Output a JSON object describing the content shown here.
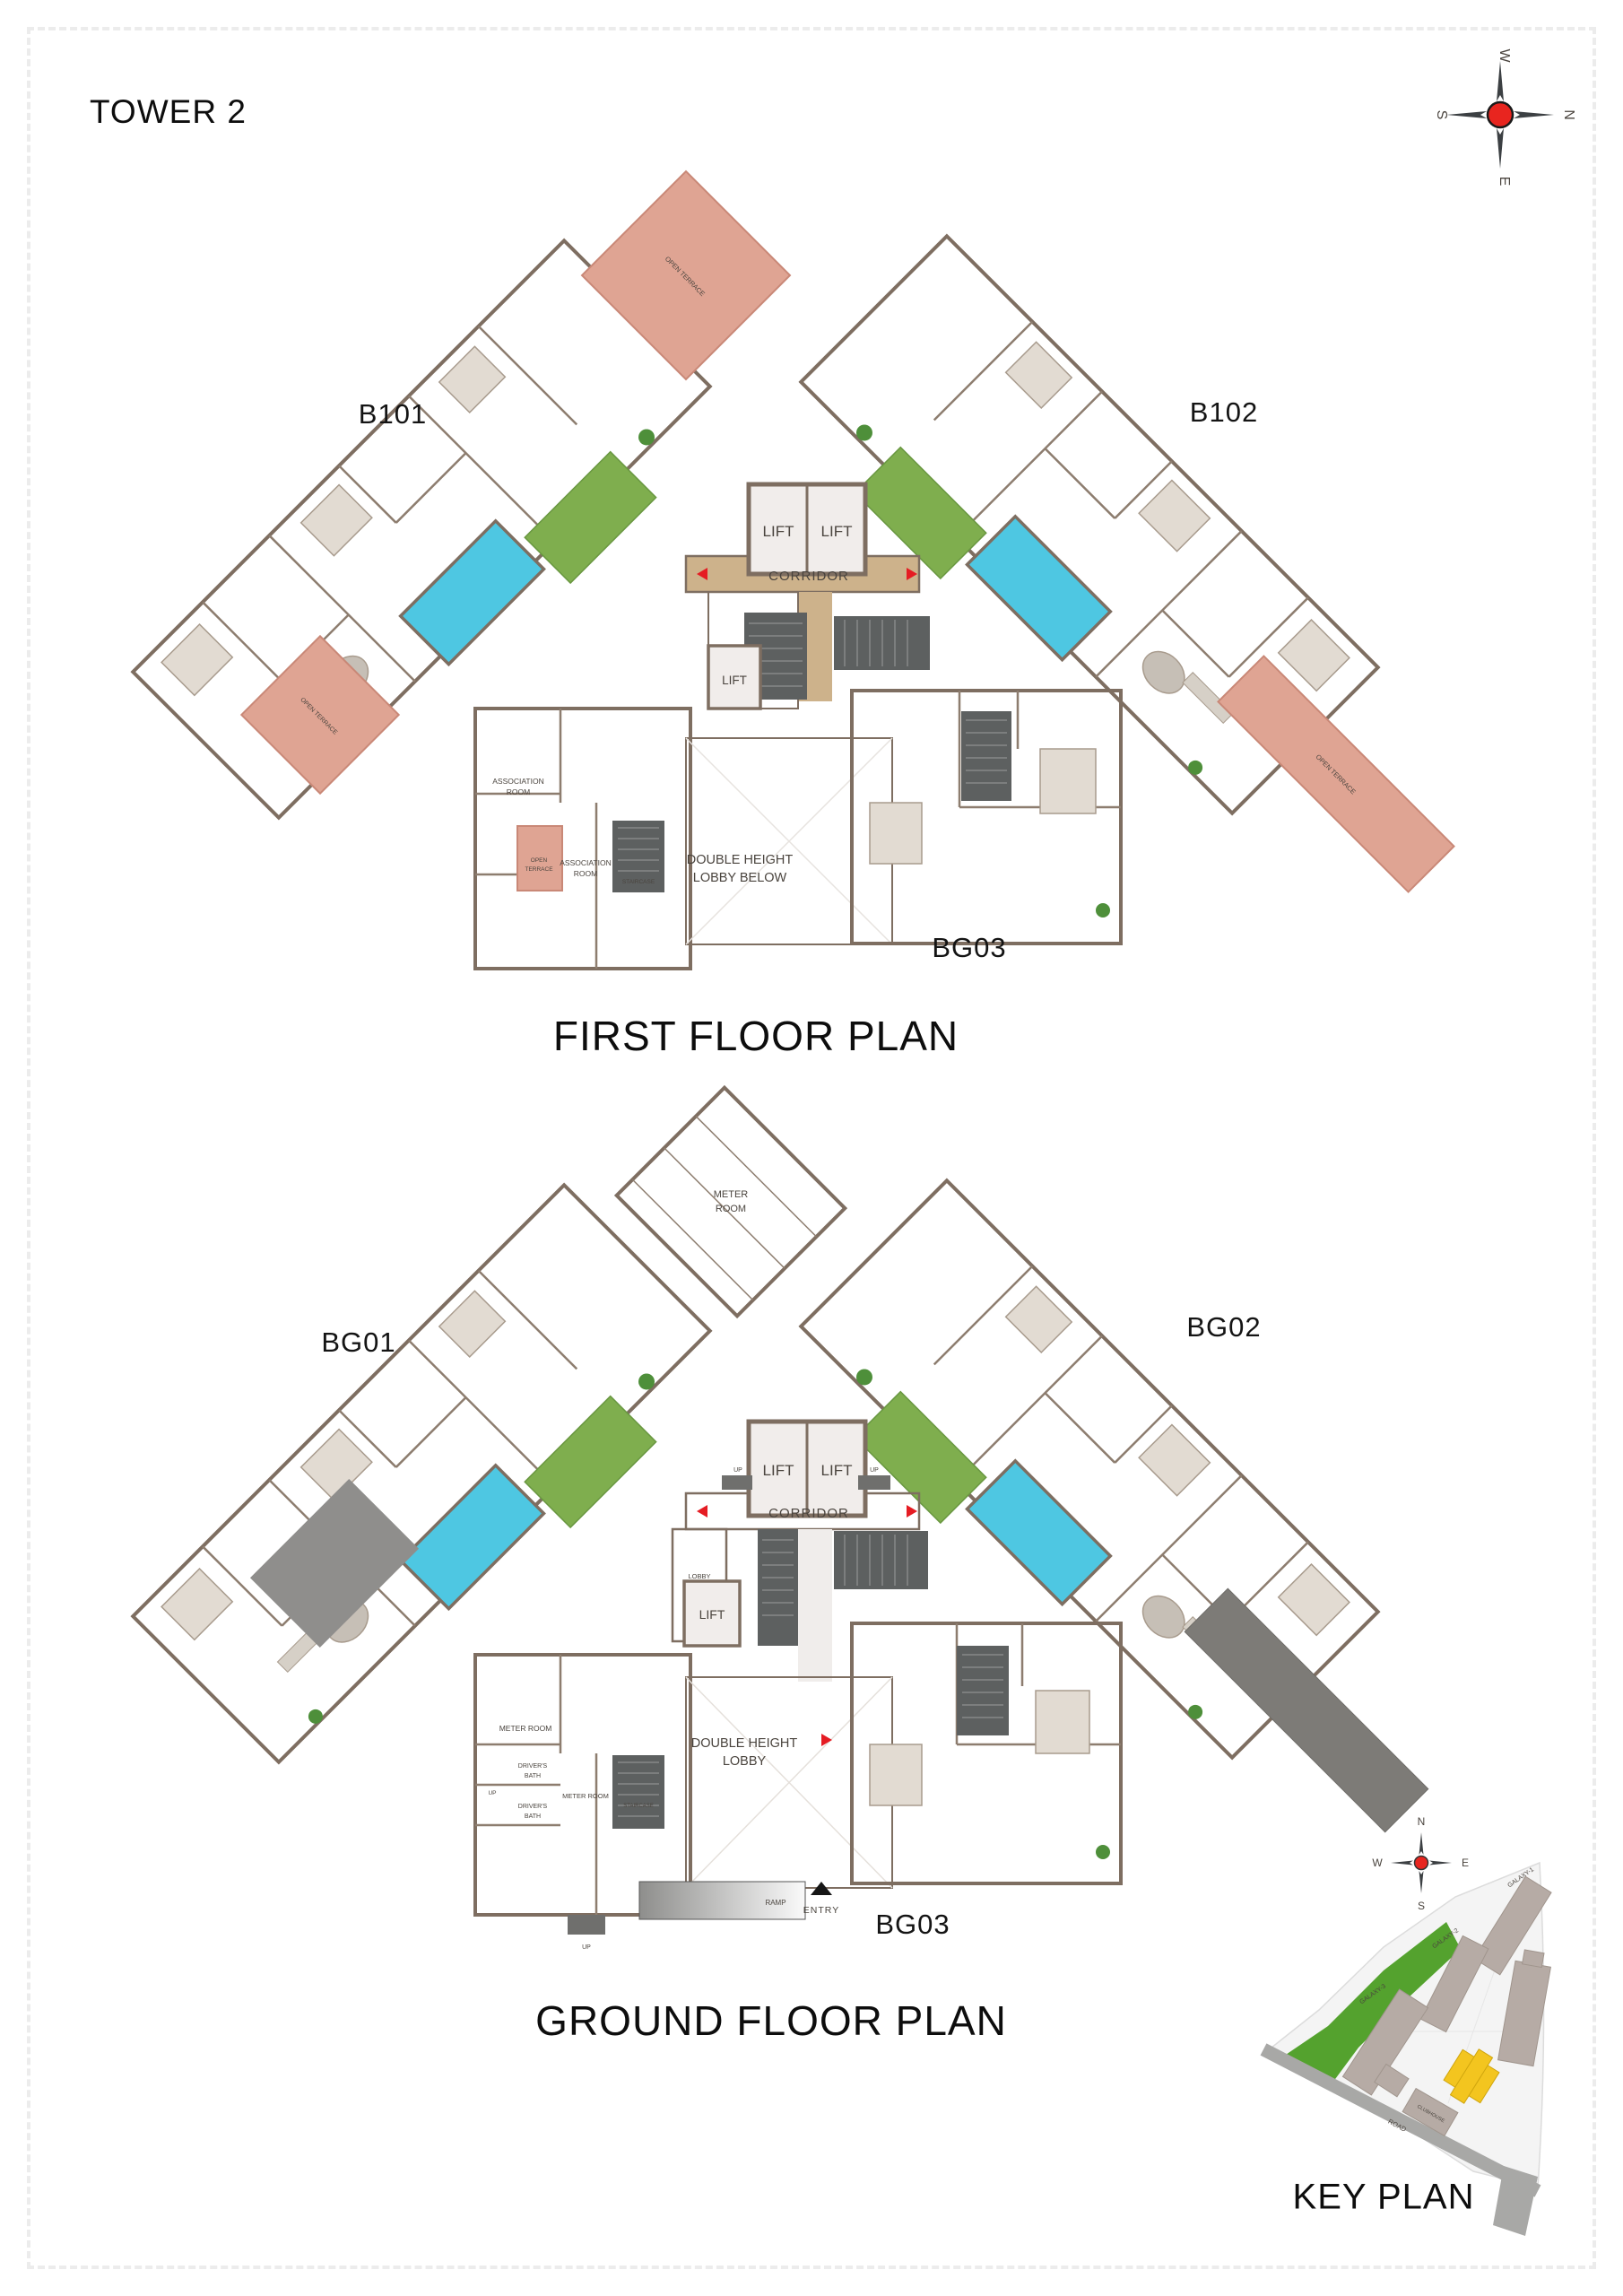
{
  "tower_title": "TOWER 2",
  "compass": {
    "n": "N",
    "e": "E",
    "s": "S",
    "w": "W"
  },
  "first_floor": {
    "title": "FIRST FLOOR PLAN",
    "units": {
      "left": "B101",
      "right": "B102",
      "bottom": "BG03"
    },
    "labels": {
      "lift": "LIFT",
      "corridor": "CORRIDOR",
      "staircase": "STAIRCASE",
      "association_room": [
        "ASSOCIATION",
        "ROOM"
      ],
      "open_terrace": "OPEN TERRACE",
      "open_terrace_lines": [
        "OPEN",
        "TERRACE"
      ],
      "double_height_lobby_below": [
        "DOUBLE HEIGHT",
        "LOBBY BELOW"
      ]
    }
  },
  "ground_floor": {
    "title": "GROUND FLOOR PLAN",
    "units": {
      "left": "BG01",
      "right": "BG02",
      "bottom": "BG03"
    },
    "labels": {
      "lift": "LIFT",
      "corridor": "CORRIDOR",
      "lobby": "LOBBY",
      "up": "UP",
      "staircase": "STAIRCASE",
      "meter_room": [
        "METER",
        "ROOM"
      ],
      "meter_room_inline": "METER ROOM",
      "drivers_bath": [
        "DRIVER'S",
        "BATH"
      ],
      "double_height_lobby": [
        "DOUBLE HEIGHT",
        "LOBBY"
      ],
      "ramp": "RAMP",
      "entry": "ENTRY"
    }
  },
  "key_plan": {
    "title": "KEY PLAN",
    "road": "ROAD",
    "buildings": {
      "galaxy1": "GALAXY-1",
      "galaxy2": "GALAXY-2",
      "galaxy3": "GALAXY-3",
      "clubhouse": "CLUBHOUSE"
    }
  },
  "colors": {
    "wall": "#7e6e61",
    "corridor_tan": "#cdb28b",
    "stair_dark": "#5d6060",
    "terrace_pink": "#dfa493",
    "pool": "#4ec7e2",
    "lawn": "#7fae4e",
    "site_green": "#54a22e",
    "highlight_yellow": "#f3c51f",
    "arrow_red": "#e51c23"
  }
}
